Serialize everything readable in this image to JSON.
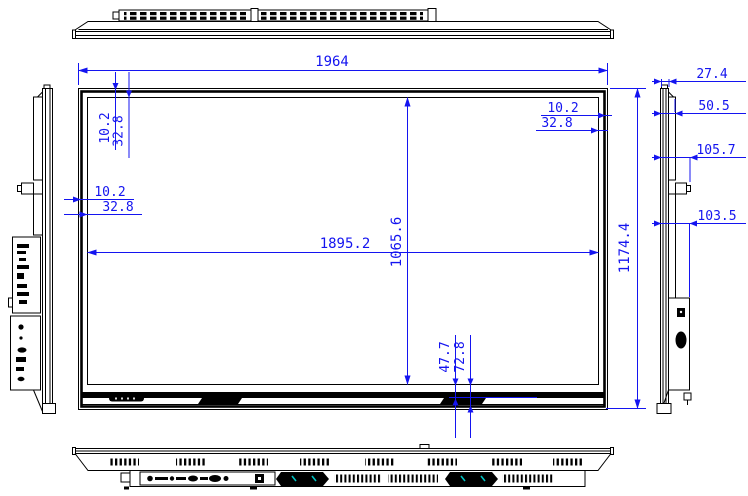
{
  "title": "Flat panel display outline dimension drawing",
  "colors": {
    "line": "#000000",
    "dim": "#1414f0",
    "accent": "#00c2c2",
    "bg": "#ffffff"
  },
  "dimensions": {
    "overall_width": "1964",
    "overall_height": "1174.4",
    "active_width": "1895.2",
    "active_height": "1065.6",
    "bezel_top_1": "10.2",
    "bezel_top_2": "32.8",
    "bezel_left_1": "10.2",
    "bezel_left_2": "32.8",
    "bezel_right_1": "10.2",
    "bezel_right_2": "32.8",
    "bezel_bottom_1": "47.7",
    "bezel_bottom_2": "72.8",
    "depth_front": "27.4",
    "depth_body": "50.5",
    "depth_button": "105.7",
    "depth_lower": "103.5"
  }
}
